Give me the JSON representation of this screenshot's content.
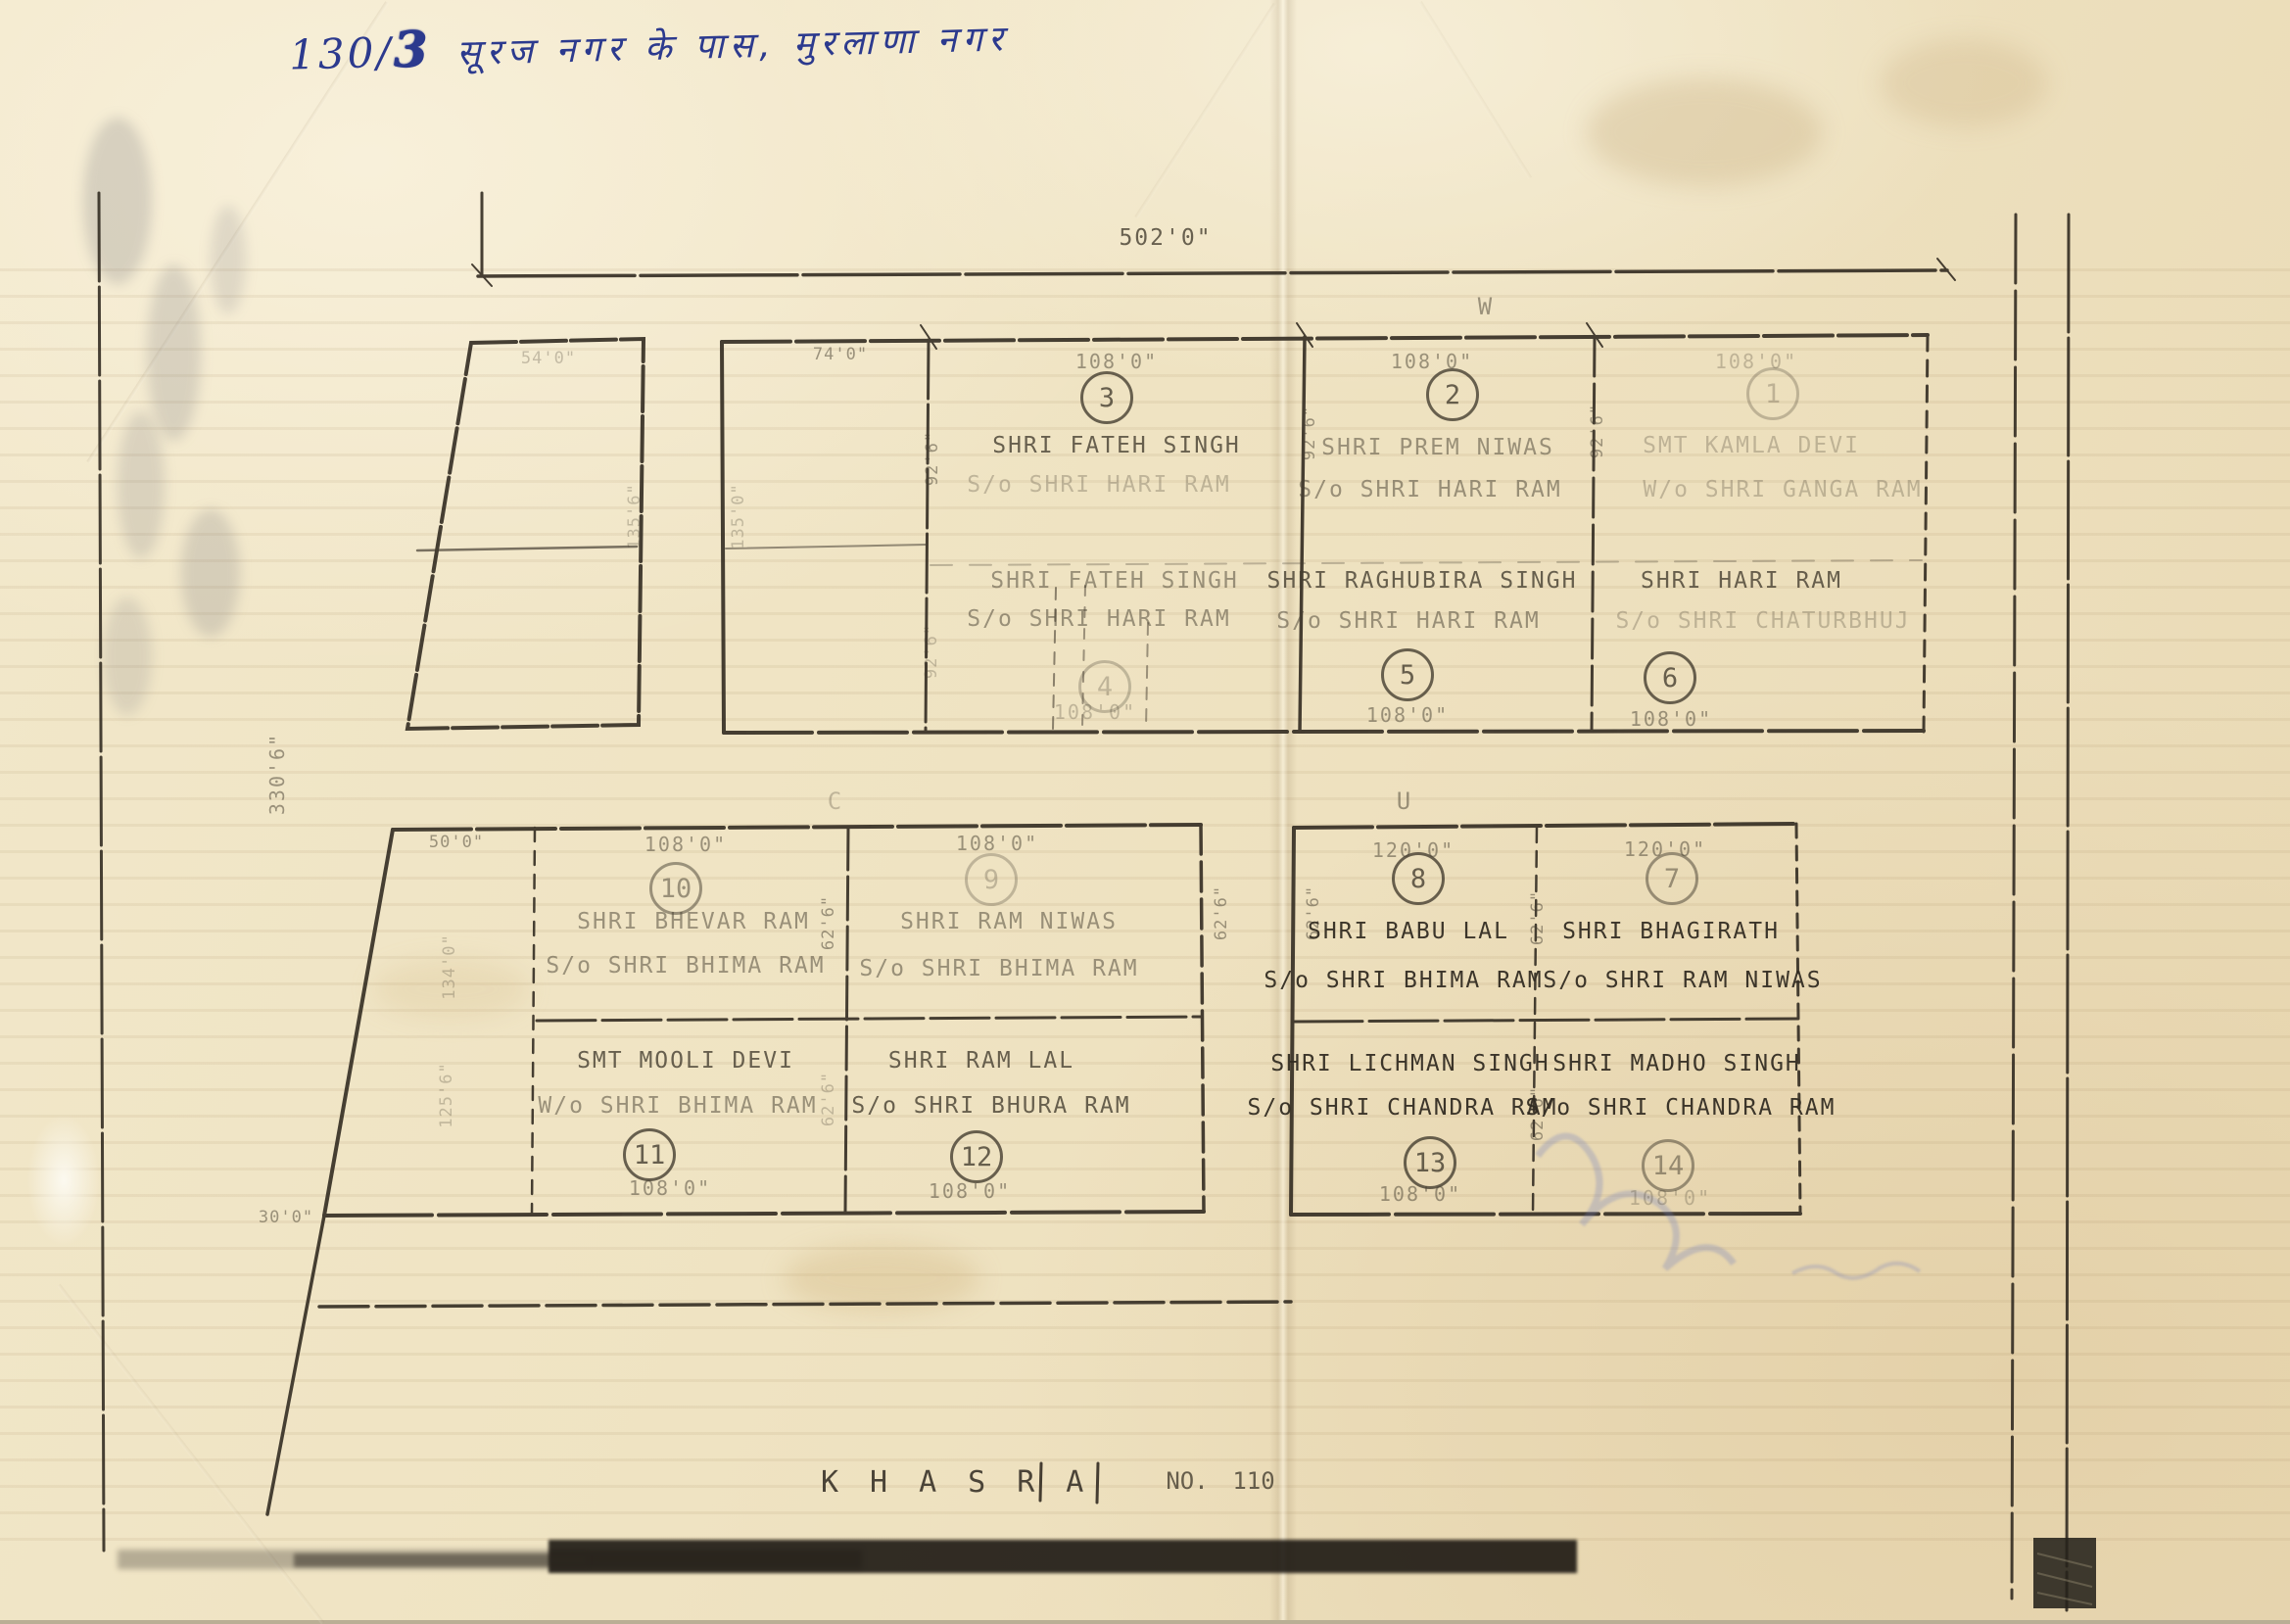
{
  "title": {
    "number_prefix": "130/",
    "number_bold": "3",
    "hindi_text": "सूरज नगर के पास, मुरलाणा नगर"
  },
  "boundary": {
    "top_width": "502'0\"",
    "left_height": "330'6\"",
    "road_letter_top": "W",
    "road_letter_mid": "U",
    "road_letter_mid2": "C",
    "bottom_left_dim": "30'0\""
  },
  "columns": {
    "trapezoid_top": "54'0\"",
    "trapezoid_side": "135'6\"",
    "col74_top": "74'0\"",
    "col74_side": "135'0\"",
    "lower_left_top": "50'0\"",
    "lower_sliver_side1": "134'0\"",
    "lower_sliver_side2": "125'6\"",
    "v_top_block": "92'6\"",
    "v_lower_block": "62'6\""
  },
  "plots": [
    {
      "no": "1",
      "dim": "108'0\"",
      "name": "SMT KAMLA DEVI",
      "rel": "W/o SHRI GANGA RAM"
    },
    {
      "no": "2",
      "dim": "108'0\"",
      "name": "SHRI PREM NIWAS",
      "rel": "S/o SHRI HARI RAM"
    },
    {
      "no": "3",
      "dim": "108'0\"",
      "name": "SHRI FATEH SINGH",
      "rel": "S/o SHRI HARI RAM"
    },
    {
      "no": "4",
      "dim": "108'0\"",
      "name": "SHRI FATEH SINGH",
      "rel": "S/o SHRI HARI RAM"
    },
    {
      "no": "5",
      "dim": "108'0\"",
      "name": "SHRI RAGHUBIRA SINGH",
      "rel": "S/o SHRI HARI RAM"
    },
    {
      "no": "6",
      "dim": "108'0\"",
      "name": "SHRI HARI RAM",
      "rel": "S/o SHRI CHATURBHUJ"
    },
    {
      "no": "7",
      "dim": "120'0\"",
      "name": "SHRI BHAGIRATH",
      "rel": "S/o SHRI RAM NIWAS"
    },
    {
      "no": "8",
      "dim": "120'0\"",
      "name": "SHRI BABU LAL",
      "rel": "S/o SHRI BHIMA RAM"
    },
    {
      "no": "9",
      "dim": "108'0\"",
      "name": "SHRI RAM NIWAS",
      "rel": "S/o SHRI BHIMA RAM"
    },
    {
      "no": "10",
      "dim": "108'0\"",
      "name": "SHRI BHEVAR RAM",
      "rel": "S/o SHRI BHIMA RAM"
    },
    {
      "no": "11",
      "dim": "108'0\"",
      "name": "SMT MOOLI DEVI",
      "rel": "W/o SHRI BHIMA RAM"
    },
    {
      "no": "12",
      "dim": "108'0\"",
      "name": "SHRI RAM LAL",
      "rel": "S/o SHRI BHURA RAM"
    },
    {
      "no": "13",
      "dim": "108'0\"",
      "name": "SHRI LICHMAN SINGH",
      "rel": "S/o SHRI CHANDRA RAM"
    },
    {
      "no": "14",
      "dim": "108'0\"",
      "name": "SHRI MADHO SINGH",
      "rel": "S/o SHRI CHANDRA RAM"
    }
  ],
  "bottom": {
    "khasra": "KHASRA",
    "no_label": "NO.",
    "khasra_number": "110"
  }
}
